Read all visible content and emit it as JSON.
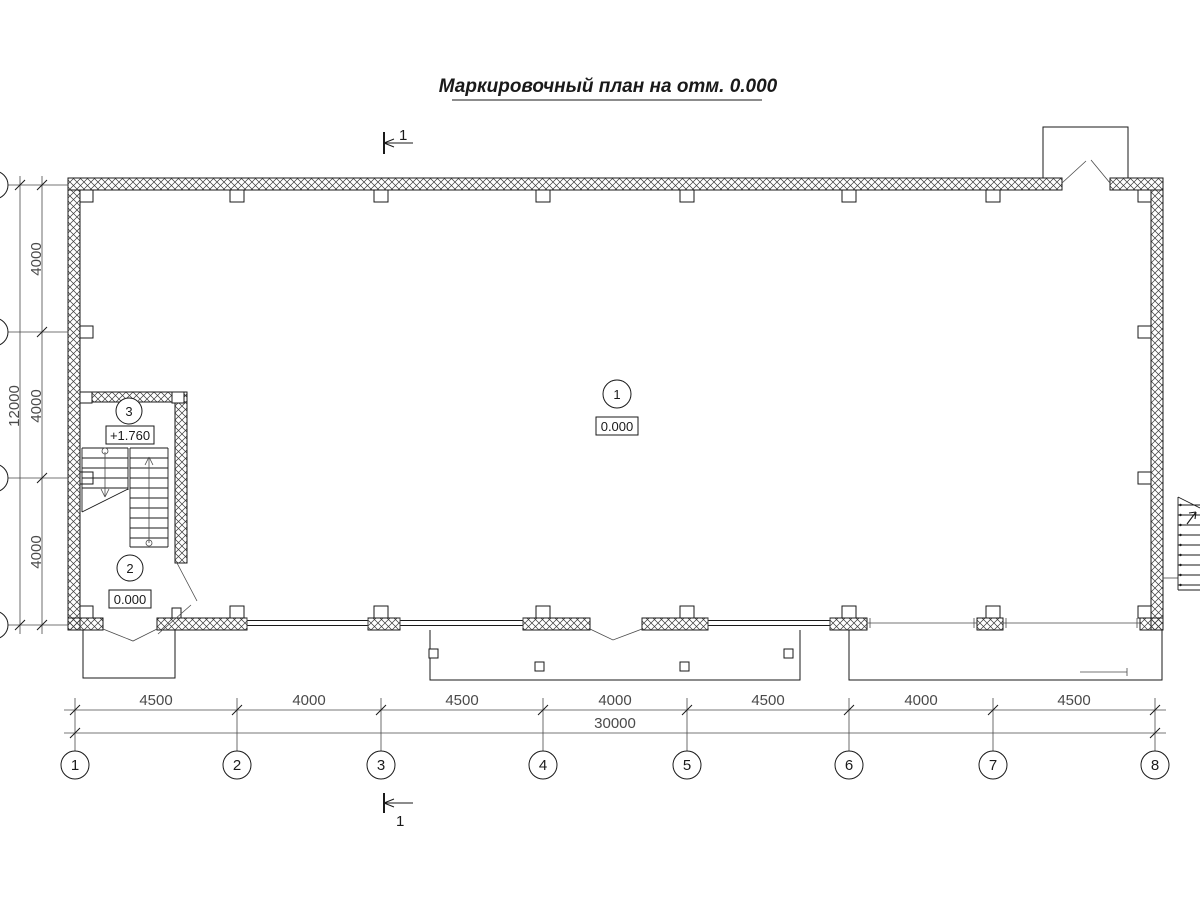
{
  "title": "Маркировочный план на отм. 0.000",
  "section_top_label": "1",
  "section_bottom_label": "1",
  "axes_bottom": [
    "1",
    "2",
    "3",
    "4",
    "5",
    "6",
    "7",
    "8"
  ],
  "dims_bottom": [
    "4500",
    "4000",
    "4500",
    "4000",
    "4500",
    "4000",
    "4500"
  ],
  "dim_bottom_total": "30000",
  "dims_left": [
    "4000",
    "4000",
    "4000"
  ],
  "dim_left_total": "12000",
  "rooms": [
    {
      "number": "1",
      "elevation": "0.000"
    },
    {
      "number": "2",
      "elevation": "0.000"
    },
    {
      "number": "3",
      "elevation": "+1.760"
    }
  ],
  "colors": {
    "line": "#1a1a1a",
    "background": "#ffffff"
  }
}
